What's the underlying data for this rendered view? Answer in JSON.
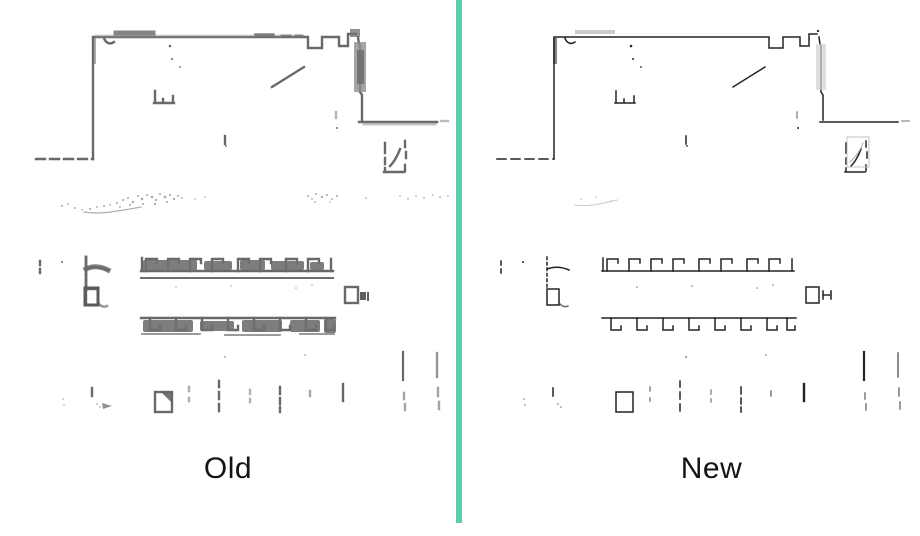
{
  "figure": {
    "divider": {
      "color": "#5CCDAE"
    },
    "panels": [
      {
        "id": "old",
        "label": "Old",
        "map_stroke_color": "#696969"
      },
      {
        "id": "new",
        "label": "New",
        "map_stroke_color": "#232323"
      }
    ]
  }
}
